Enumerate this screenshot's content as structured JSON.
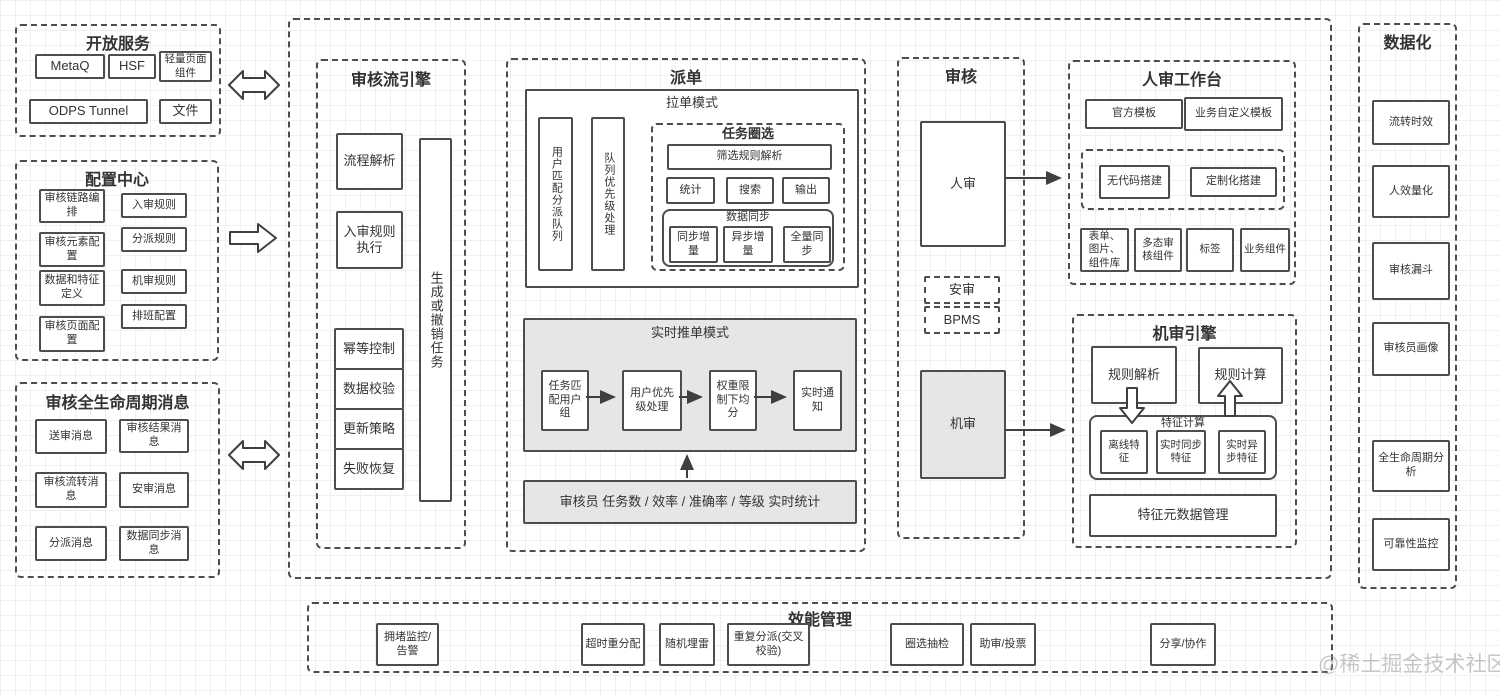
{
  "colors": {
    "stroke": "#4d4d4d",
    "gray_fill": "#e6e6e6",
    "background": "#ffffff"
  },
  "watermark": "@稀土掘金技术社区",
  "open_services": {
    "title": "开放服务",
    "items": [
      "MetaQ",
      "HSF",
      "轻量页面组件",
      "ODPS Tunnel",
      "文件"
    ]
  },
  "config_center": {
    "title": "配置中心",
    "left": [
      "审核链路编排",
      "审核元素配置",
      "数据和特征定义",
      "审核页面配置"
    ],
    "right": [
      "入审规则",
      "分派规则",
      "机审规则",
      "排班配置"
    ]
  },
  "lifecycle_messages": {
    "title": "审核全生命周期消息",
    "items": [
      "送审消息",
      "审核结果消息",
      "审核流转消息",
      "安审消息",
      "分派消息",
      "数据同步消息"
    ]
  },
  "flow_engine": {
    "title": "审核流引擎",
    "items": [
      "流程解析",
      "入审规则执行"
    ],
    "stack": [
      "幂等控制",
      "数据校验",
      "更新策略",
      "失败恢复"
    ],
    "vertical": "生成或撤销任务"
  },
  "dispatch": {
    "title": "派单",
    "pull_mode": {
      "title": "拉单模式",
      "queues": [
        "用户匹配分派队列",
        "队列优先级处理"
      ],
      "task_select": {
        "title": "任务圈选",
        "parse": "筛选规则解析",
        "ops": [
          "统计",
          "搜索",
          "输出"
        ],
        "sync": {
          "title": "数据同步",
          "items": [
            "同步增量",
            "异步增量",
            "全量同步"
          ]
        }
      }
    },
    "push_mode": {
      "title": "实时推单模式",
      "steps": [
        "任务匹配用户组",
        "用户优先级处理",
        "权重限制下均分",
        "实时通知"
      ]
    },
    "stats_bar": "审核员 任务数 / 效率 / 准确率 / 等级 实时统计"
  },
  "audit": {
    "title": "审核",
    "human": "人审",
    "sub": [
      "安审",
      "BPMS"
    ],
    "machine": "机审"
  },
  "workbench": {
    "title": "人审工作台",
    "templates": [
      "官方模板",
      "业务自定义模板"
    ],
    "build": [
      "无代码搭建",
      "定制化搭建"
    ],
    "components": [
      "表单、图片、组件库",
      "多态审核组件",
      "标签",
      "业务组件"
    ]
  },
  "machine_engine": {
    "title": "机审引擎",
    "rule_parse": "规则解析",
    "rule_calc": "规则计算",
    "feature_calc": {
      "title": "特征计算",
      "items": [
        "离线特征",
        "实时同步特征",
        "实时异步特征"
      ]
    },
    "meta": "特征元数据管理"
  },
  "dataization": {
    "title": "数据化",
    "items": [
      "流转时效",
      "人效量化",
      "审核漏斗",
      "审核员画像",
      "全生命周期分析",
      "可靠性监控"
    ]
  },
  "efficiency": {
    "title": "效能管理",
    "items": [
      "拥堵监控/告警",
      "超时重分配",
      "随机埋雷",
      "重复分派(交叉校验)",
      "圈选抽检",
      "助审/投票",
      "分享/协作"
    ]
  }
}
